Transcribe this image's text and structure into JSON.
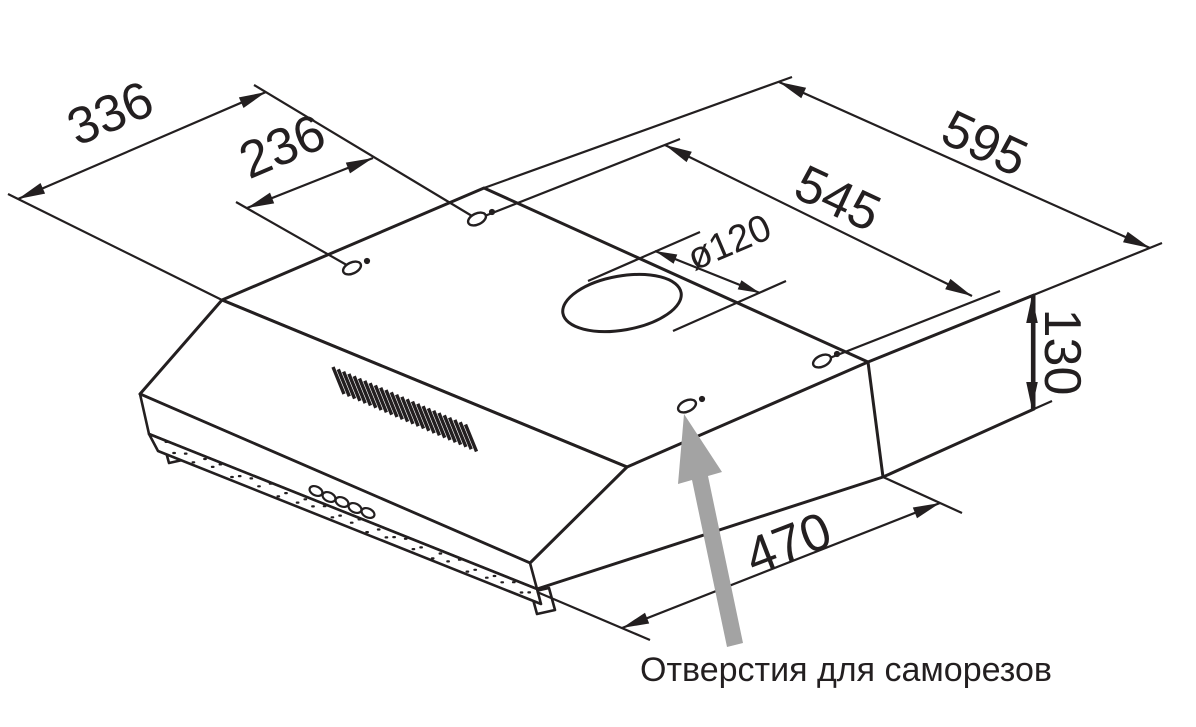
{
  "diagram": {
    "caption": "Отверстия для саморезов",
    "dimensions": {
      "top_depth": "336",
      "hole_spacing_depth": "236",
      "top_width": "595",
      "hole_spacing_width": "545",
      "duct_diameter": "ø120",
      "body_height": "130",
      "bottom_depth": "470"
    },
    "colors": {
      "line": "#231f20",
      "pointer": "#a3a3a3",
      "background": "#ffffff"
    }
  }
}
